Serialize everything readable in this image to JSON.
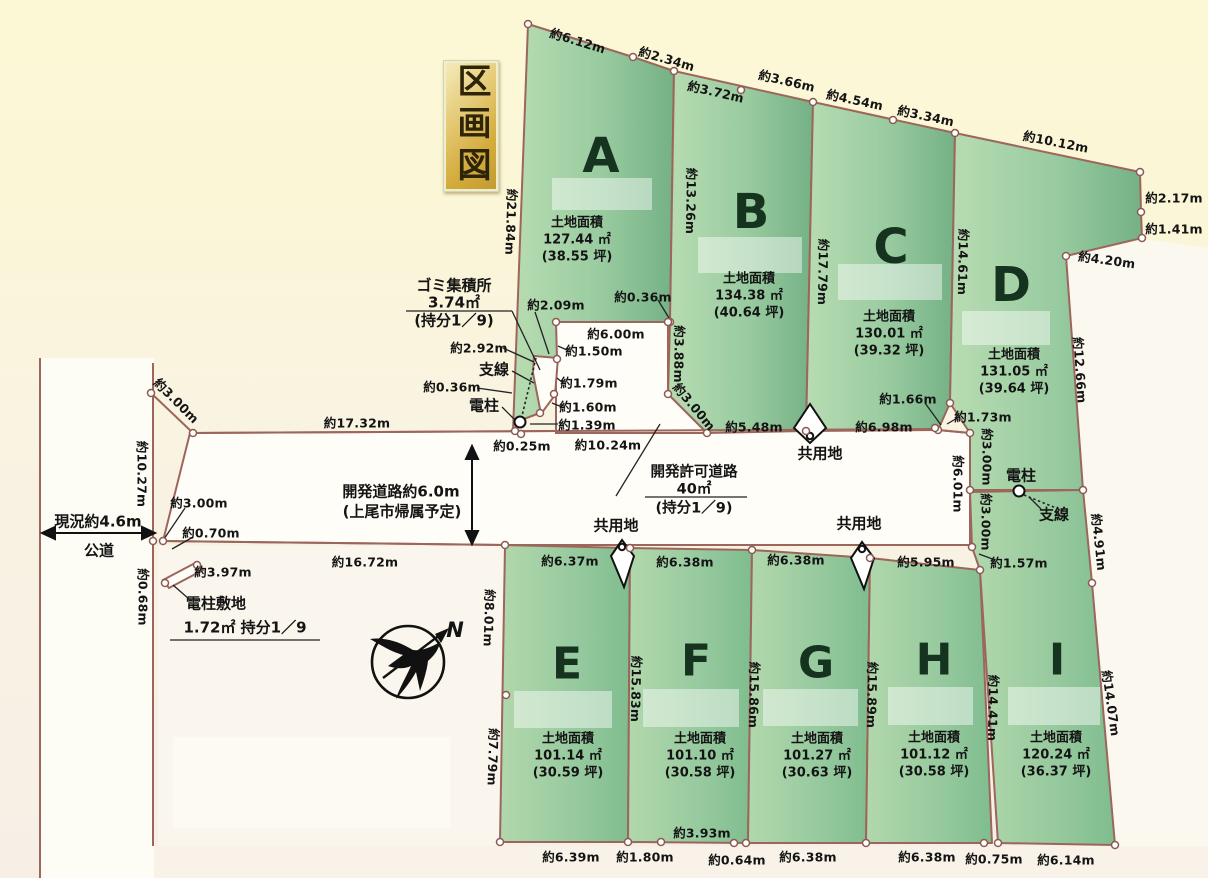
{
  "title": "区画図",
  "plots": [
    {
      "letter": "A",
      "area_title": "土地面積",
      "area_m2": "127.44 ㎡",
      "area_tsubo": "(38.55 坪)"
    },
    {
      "letter": "B",
      "area_title": "土地面積",
      "area_m2": "134.38 ㎡",
      "area_tsubo": "(40.64 坪)"
    },
    {
      "letter": "C",
      "area_title": "土地面積",
      "area_m2": "130.01 ㎡",
      "area_tsubo": "(39.32 坪)"
    },
    {
      "letter": "D",
      "area_title": "土地面積",
      "area_m2": "131.05 ㎡",
      "area_tsubo": "(39.64 坪)"
    },
    {
      "letter": "E",
      "area_title": "土地面積",
      "area_m2": "101.14 ㎡",
      "area_tsubo": "(30.59 坪)"
    },
    {
      "letter": "F",
      "area_title": "土地面積",
      "area_m2": "101.10 ㎡",
      "area_tsubo": "(30.58 坪)"
    },
    {
      "letter": "G",
      "area_title": "土地面積",
      "area_m2": "101.27 ㎡",
      "area_tsubo": "(30.63 坪)"
    },
    {
      "letter": "H",
      "area_title": "土地面積",
      "area_m2": "101.12 ㎡",
      "area_tsubo": "(30.58 坪)"
    },
    {
      "letter": "I",
      "area_title": "土地面積",
      "area_m2": "120.24 ㎡",
      "area_tsubo": "(36.37 坪)"
    }
  ],
  "measurements": {
    "a_top_1": "約6.12m",
    "a_top_2": "約2.34m",
    "b_top_1": "約3.72m",
    "b_top_2": "約3.66m",
    "c_top_1": "約4.54m",
    "c_top_2": "約3.34m",
    "d_top": "約10.12m",
    "right_1": "約2.17m",
    "right_2": "約1.41m",
    "right_3": "約4.20m",
    "d_right": "約12.66m",
    "a_left": "約21.84m",
    "ab_side": "約13.26m",
    "bc_side": "約17.79m",
    "cd_side": "約14.61m",
    "gomi_edge": "約2.09m",
    "b_corner": "約0.36m",
    "a_bottom": "約6.00m",
    "seg_150": "約1.50m",
    "seg_292": "約2.92m",
    "seg_179": "約1.79m",
    "pole_036": "約0.36m",
    "seg_160": "約1.60m",
    "seg_139": "約1.39m",
    "seg_025": "約0.25m",
    "road_1024": "約10.24m",
    "road_1732": "約17.32m",
    "b_388": "約3.88m",
    "b_300": "約3.00m",
    "b_bottom": "約5.48m",
    "c_bottom": "約6.98m",
    "c_166": "約1.66m",
    "d_173": "約1.73m",
    "d_300a": "約3.00m",
    "d_300b": "約3.00m",
    "road_601": "約6.01m",
    "e491": "約4.91m",
    "i_157": "約1.57m",
    "left_1027": "約10.27m",
    "left_300": "約3.00m",
    "left_300b": "約3.00m",
    "left_070": "約0.70m",
    "left_397": "約3.97m",
    "left_068": "約0.68m",
    "road_1672": "約16.72m",
    "e_top": "約6.37m",
    "f_top": "約6.38m",
    "g_top": "約6.38m",
    "h_top": "約5.95m",
    "e_left_1": "約8.01m",
    "e_left_2": "約7.79m",
    "ef_side": "約15.83m",
    "fg_side": "約15.86m",
    "gh_side": "約15.89m",
    "hi_side": "約14.41m",
    "i_right": "約14.07m",
    "e_bot": "約6.39m",
    "f_bot_1": "約1.80m",
    "f_bot_2": "約3.93m",
    "f_bot_3": "約0.64m",
    "g_bot": "約6.38m",
    "h_bot": "約6.38m",
    "i_bot_1": "約0.75m",
    "i_bot_2": "約6.14m"
  },
  "facilities": {
    "gomi_title": "ゴミ集積所",
    "gomi_area": "3.74㎡",
    "gomi_share": "(持分1／9)",
    "wire": "支線",
    "pole": "電柱",
    "pole2": "電柱",
    "wire2": "支線",
    "pole_site": "電柱敷地",
    "pole_site_detail": "1.72㎡ 持分1／9"
  },
  "road": {
    "dev_1": "開発道路約6.0m",
    "dev_2": "(上尾市帰属予定)",
    "permit_1": "開発許可道路",
    "permit_2": "40㎡",
    "permit_3": "(持分1／9)",
    "common_1": "共用地",
    "common_2": "共用地",
    "common_3": "共用地"
  },
  "left_road": {
    "current": "現況約4.6m",
    "public": "公道"
  },
  "compass": {
    "north": "N"
  },
  "colors": {
    "plot_green_light": "#b6dab0",
    "plot_green_dark": "#76b286",
    "line_brown": "#9c665c",
    "road_white": "#fffdf8",
    "bg_cream": "#fbf6d6",
    "title_gold": "#d4ab3c"
  }
}
